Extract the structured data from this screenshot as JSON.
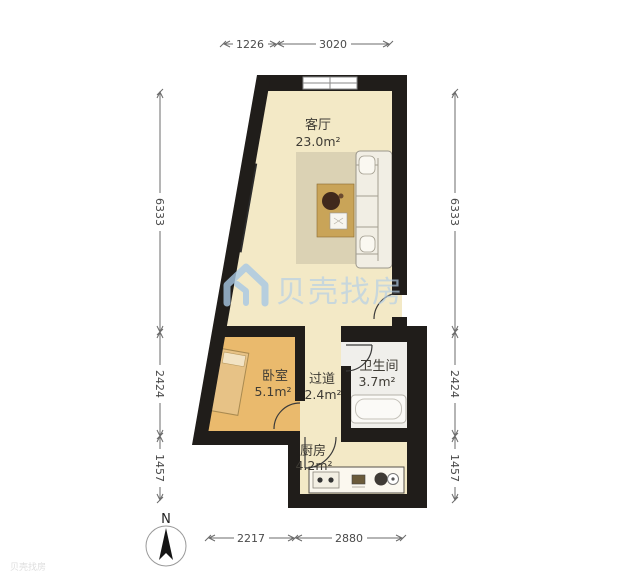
{
  "floorplan": {
    "watermark": {
      "brand": "贝壳找房",
      "corner_mark": "贝壳找房",
      "color": "#aecbe6"
    },
    "compass": {
      "label": "N"
    },
    "wall_color": "#201d1a",
    "rooms": [
      {
        "id": "living",
        "name": "客厅",
        "area": "23.0m²",
        "floor_color": "#f3e9c6"
      },
      {
        "id": "bedroom",
        "name": "卧室",
        "area": "5.1m²",
        "floor_color": "#eaba6d"
      },
      {
        "id": "hallway",
        "name": "过道",
        "area": "2.4m²",
        "floor_color": "#f3e9c6"
      },
      {
        "id": "bathroom",
        "name": "卫生间",
        "area": "3.7m²",
        "floor_color": "#f0efeb"
      },
      {
        "id": "kitchen",
        "name": "厨房",
        "area": "4.2m²",
        "floor_color": "#f3e9c6"
      }
    ],
    "dimensions": {
      "top": [
        {
          "label": "1226"
        },
        {
          "label": "3020"
        }
      ],
      "left": [
        {
          "label": "6333"
        },
        {
          "label": "2424"
        },
        {
          "label": "1457"
        }
      ],
      "right": [
        {
          "label": "6333"
        },
        {
          "label": "2424"
        },
        {
          "label": "1457"
        }
      ],
      "bottom": [
        {
          "label": "2217"
        },
        {
          "label": "2880"
        }
      ]
    }
  }
}
